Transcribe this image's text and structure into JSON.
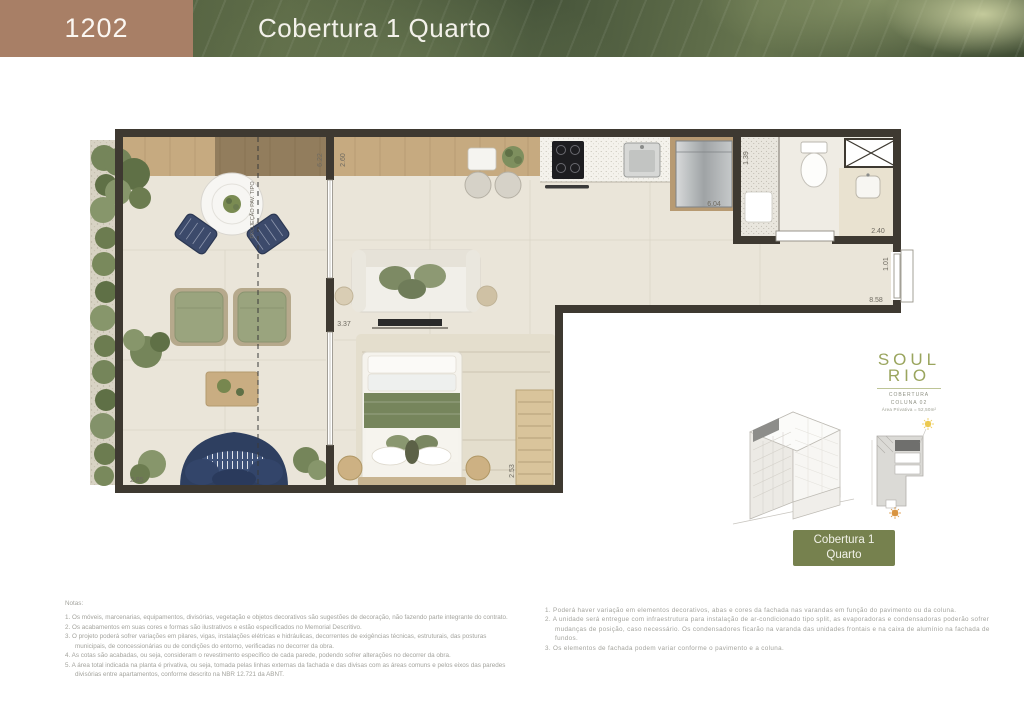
{
  "header": {
    "unit_number": "1202",
    "title": "Cobertura 1 Quarto"
  },
  "plan": {
    "projection_label": "PROJEÇÃO PAV. TIPO",
    "dims": {
      "terrace_top": "6.22",
      "living_top": "2.60",
      "kitchen_run": "6.04",
      "shower": "1.39",
      "bath_width": "2.40",
      "hall": "1.01",
      "strip_length": "8.58",
      "living_width": "3.37",
      "bedroom": "2.53",
      "terrace_bottom": "2.85"
    }
  },
  "branding": {
    "logo_top": "SOUL",
    "logo_bottom": "RIO",
    "caption_1": "COBERTURA",
    "caption_2": "COLUNA 02",
    "caption_3": "Área Privativa = 52,50m²"
  },
  "badge": {
    "line1": "Cobertura 1",
    "line2": "Quarto"
  },
  "notes_left": {
    "title": "Notas:",
    "items": [
      "1. Os móveis, marcenarias, equipamentos, divisórias, vegetação e objetos decorativos são sugestões de decoração, não fazendo parte integrante do contrato.",
      "2. Os acabamentos em suas cores e formas são ilustrativos e estão especificados no Memorial Descritivo.",
      "3. O projeto poderá sofrer variações em pilares, vigas, instalações elétricas e hidráulicas, decorrentes de exigências técnicas, estruturais, das posturas municipais, de concessionárias ou de condições do entorno, verificadas no decorrer da obra.",
      "4. As cotas são acabadas, ou seja, consideram o revestimento específico de cada parede, podendo sofrer alterações no decorrer da obra.",
      "5. A área total indicada na planta é privativa, ou seja, tomada pelas linhas externas da fachada e das divisas com as áreas comuns e pelos eixos das paredes divisórias entre apartamentos, conforme descrito na NBR 12.721 da ABNT."
    ]
  },
  "notes_right": {
    "items": [
      "1. Poderá haver variação em elementos decorativos, abas e cores da fachada nas varandas em função do pavimento ou da coluna.",
      "2. A unidade será entregue com infraestrutura para instalação de ar-condicionado tipo split, as evaporadoras e condensadoras poderão sofrer mudanças de posição, caso necessário. Os condensadores ficarão na varanda das unidades frontais e na caixa de alumínio na fachada de fundos.",
      "3. Os elementos de fachada podem variar conforme o pavimento e a coluna."
    ]
  },
  "colors": {
    "header_brown": "#a87f66",
    "leaf_green": "#4c5a3c",
    "wall": "#3e3931",
    "badge_green": "#76814e",
    "logo_green": "#9aa55e",
    "floor": "#eae5d9",
    "wood": "#c6aa80",
    "navy_sofa": "#33456a",
    "olive_cushion": "#7d8a64"
  }
}
